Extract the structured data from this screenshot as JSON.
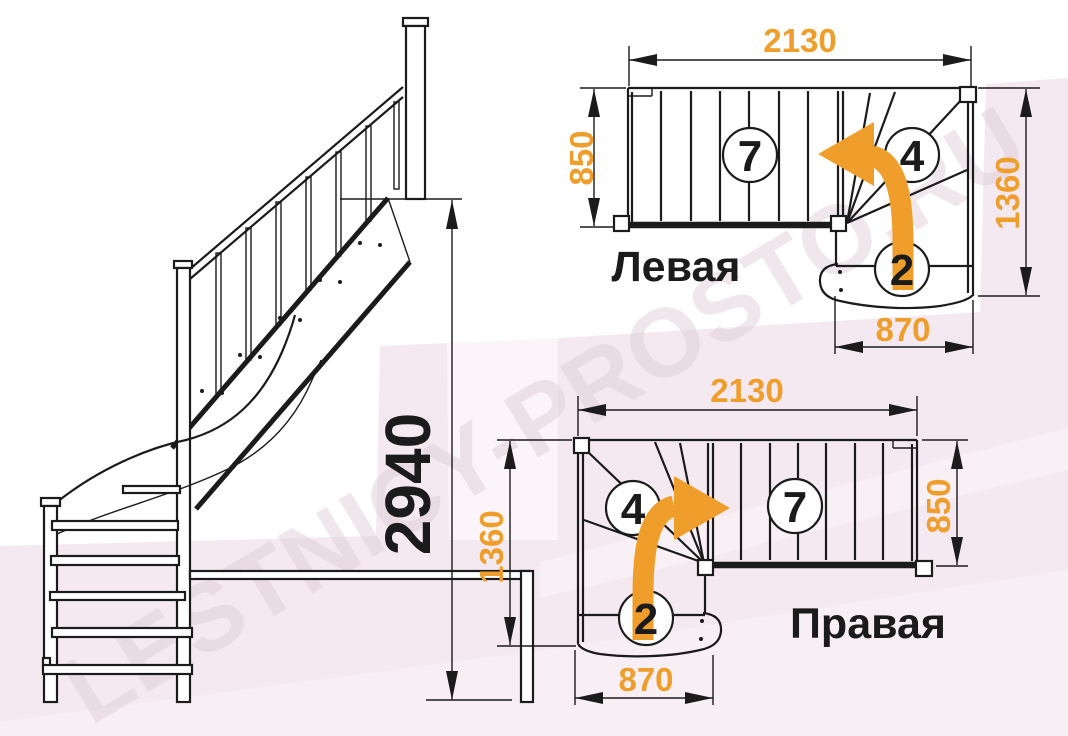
{
  "watermark": {
    "text": "LESTNICY-PROSTO.RU"
  },
  "colors": {
    "accent_orange": "#EF9E2B",
    "line_black": "#1B1B1B",
    "background_pink": "#F5E9F1"
  },
  "elevation": {
    "total_height": "2940"
  },
  "plan_left": {
    "label": "Левая",
    "dim_top_width": "2130",
    "dim_flight_depth": "850",
    "dim_side_height": "1360",
    "dim_winder_width": "870",
    "straight_steps_count": "7",
    "winder_steps_count": "4",
    "lower_steps_count": "2"
  },
  "plan_right": {
    "label": "Правая",
    "dim_top_width": "2130",
    "dim_flight_depth": "850",
    "dim_side_height": "1360",
    "dim_winder_width": "870",
    "straight_steps_count": "7",
    "winder_steps_count": "4",
    "lower_steps_count": "2"
  }
}
